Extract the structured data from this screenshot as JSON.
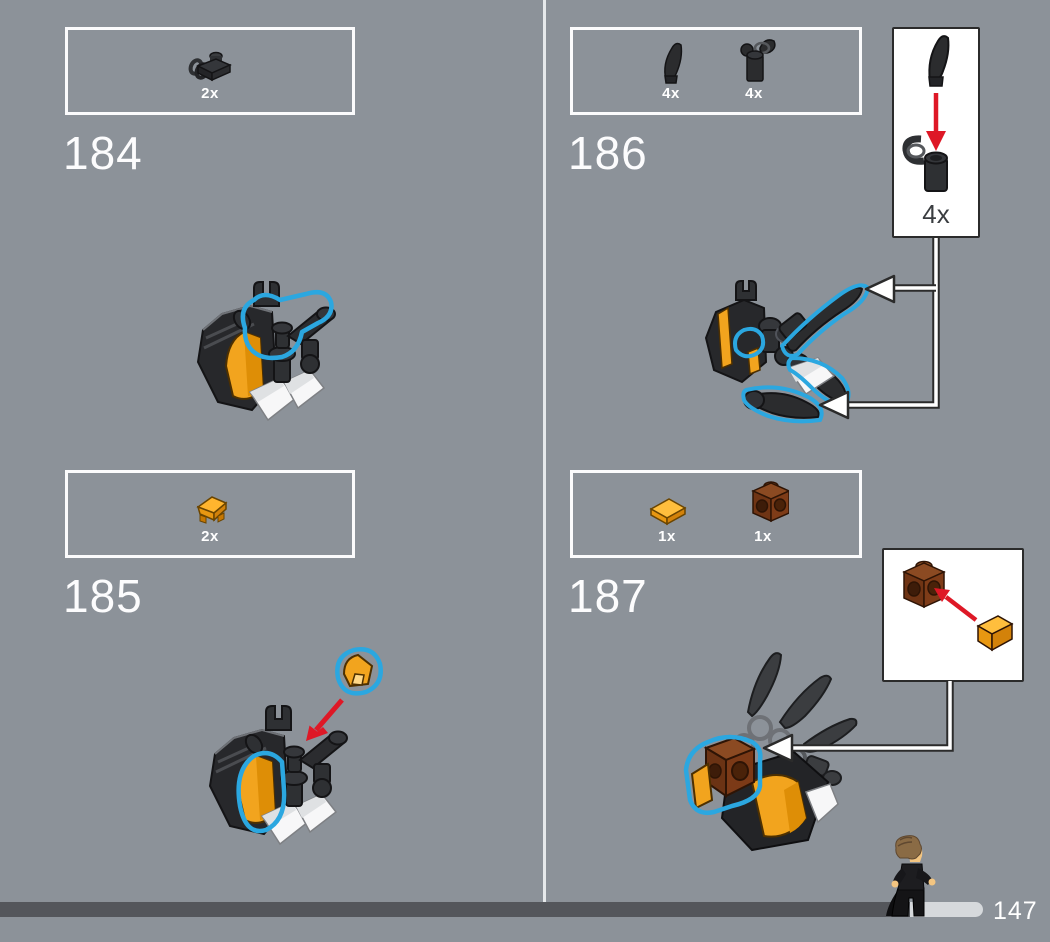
{
  "page": {
    "background_color": "#8C9299",
    "page_number": "147"
  },
  "colors": {
    "highlight_blue": "#2BA7E0",
    "arrow_red": "#DE1826",
    "brick_orange": "#F2A41E",
    "brick_brown": "#7C3A17",
    "brick_black": "#2B2C2E",
    "progress_bar_dark": "#54565B",
    "progress_bar_light": "#D6D9DC",
    "parts_box_border": "#FBFBFC",
    "callout_border": "#2B2B2B"
  },
  "steps": [
    {
      "number": "184",
      "parts": [
        {
          "qty": "2x",
          "piece": "black-clip-plate"
        }
      ]
    },
    {
      "number": "185",
      "parts": [
        {
          "qty": "2x",
          "piece": "orange-wedge-plate"
        }
      ]
    },
    {
      "number": "186",
      "parts": [
        {
          "qty": "4x",
          "piece": "black-claw-horn"
        },
        {
          "qty": "4x",
          "piece": "black-robot-arm-with-clip"
        }
      ],
      "callout": {
        "qty": "4x"
      }
    },
    {
      "number": "187",
      "parts": [
        {
          "qty": "1x",
          "piece": "orange-tile-1x1"
        },
        {
          "qty": "1x",
          "piece": "brown-brick-with-side-studs"
        }
      ]
    }
  ]
}
